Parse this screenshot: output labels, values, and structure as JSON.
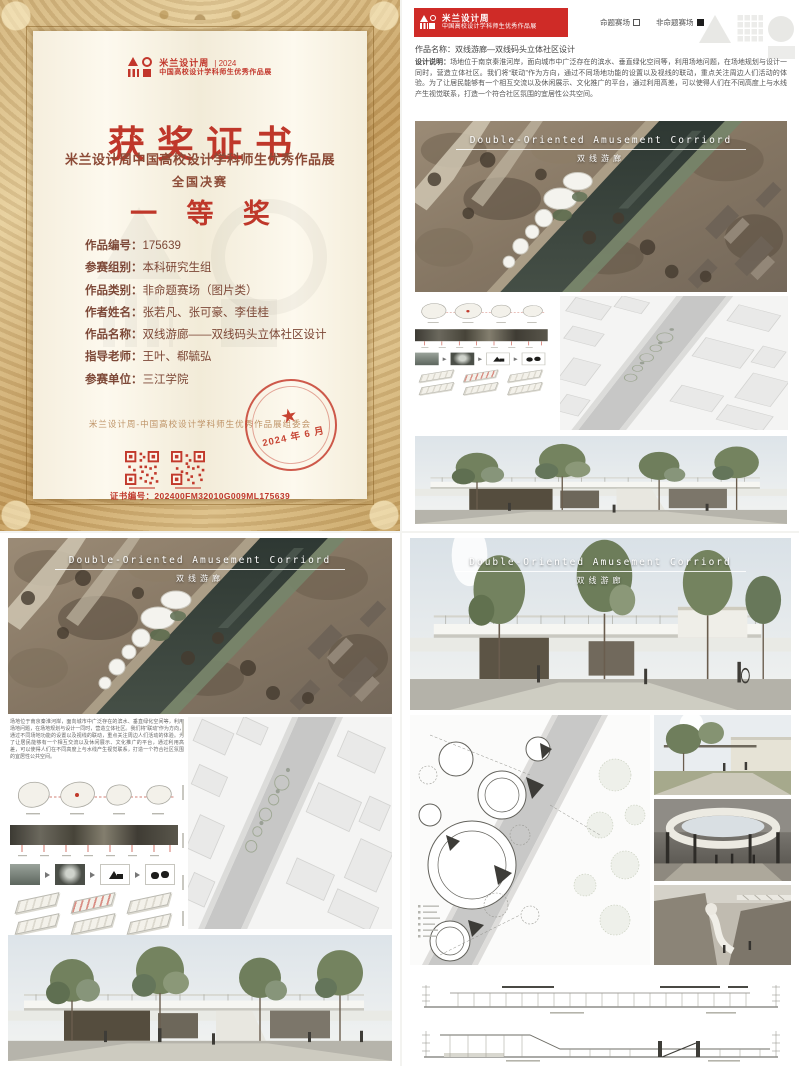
{
  "icons": {
    "star": "★"
  },
  "certificate": {
    "logo": {
      "brand": "米兰设计周",
      "year": "| 2024",
      "brand_sub": "中国高校设计学科师生优秀作品展"
    },
    "title": "获奖证书",
    "exhibition_line": "米兰设计周中国高校设计学科师生优秀作品展",
    "stage_line": "全国决赛",
    "award": "一 等 奖",
    "fields": [
      {
        "label": "作品编号：",
        "value": "175639"
      },
      {
        "label": "参赛组别：",
        "value": "本科研究生组"
      },
      {
        "label": "作品类别：",
        "value": "非命题赛场（图片类）"
      },
      {
        "label": "作者姓名：",
        "value": "张若凡、张可豪、李佳桂"
      },
      {
        "label": "作品名称：",
        "value": "双线游廊——双线码头立体社区设计"
      },
      {
        "label": "指导老师：",
        "value": "王叶、郗毓弘"
      },
      {
        "label": "参赛单位：",
        "value": "三江学院"
      }
    ],
    "committee_line": "米兰设计周-中国高校设计学科师生优秀作品展组委会",
    "stamp_date": "2024 年 6 月",
    "cert_no": "证书编号：202400FM32010G009ML175639"
  },
  "poster_top_right": {
    "banner": {
      "brand": "米兰设计周",
      "brand_sub": "中国高校设计学科师生优秀作品展"
    },
    "category_options": [
      {
        "label": "命题赛场",
        "checked": false
      },
      {
        "label": "非命题赛场",
        "checked": true
      }
    ],
    "work_title": "作品名称：双线游廊—双线码头立体社区设计",
    "desc_label": "设计说明：",
    "description": "场地位于南京秦淮河岸，面向城市中广泛存在的滨水、垂直绿化空间等，利用场地问题，在场地规划与设计一同时，营造立体社区。我们将“联动”作为方向，通过不同场地功能的设置以及视线的联动，重点关注周边人们活动的体验。为了让居民能够有一个相互交流以及休闲展示、文化推广的平台，通过利用高差，可以使得人们在不同高度上与水线产生视觉联系，打造一个符合社区氛围的宜居性公共空间。",
    "hero_title_en": "Double-Oriented Amusement Corriord",
    "hero_title_cn": "双线游廊"
  },
  "poster_bottom_left": {
    "hero_title_en": "Double-Oriented Amusement Corriord",
    "hero_title_cn": "双线游廊",
    "description": "场地位于南京秦淮河岸，面向城市中广泛存在的滨水、垂直绿化空间等，利用场地问题，在场地规划与设计一同时，营造立体社区。我们将“联动”作为方向，通过不同场地功能的设置以及视线的联动，重点关注周边人们活动的体验。为了让居民能够有一个相互交流以及休闲展示、文化推广的平台，通过利用高差，可以使得人们在不同高度上与水线产生视觉联系，打造一个符合社区氛围的宜居性公共空间。"
  },
  "poster_bottom_right": {
    "hero_title_en": "Double-Oriented Amusement Corriord",
    "hero_title_cn": "双线游廊"
  }
}
